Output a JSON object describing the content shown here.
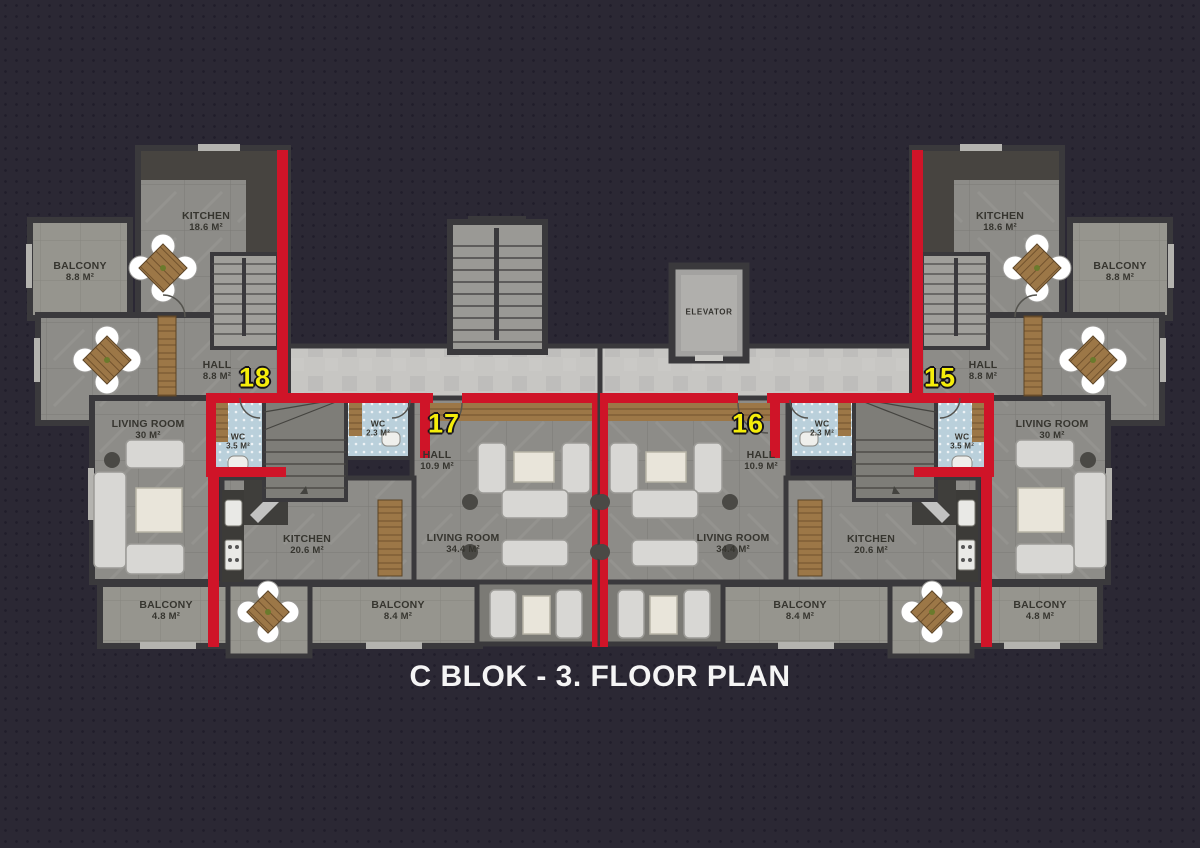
{
  "title": "C BLOK - 3. FLOOR PLAN",
  "units": {
    "u15": "15",
    "u16": "16",
    "u17": "17",
    "u18": "18"
  },
  "rooms": {
    "kitchen_186": {
      "name": "KITCHEN",
      "area": "18.6 M²"
    },
    "balcony_88": {
      "name": "BALCONY",
      "area": "8.8 M²"
    },
    "hall_88": {
      "name": "HALL",
      "area": "8.8 M²"
    },
    "living_30": {
      "name": "LIVING ROOM",
      "area": "30 M²"
    },
    "wc_35": {
      "name": "WC",
      "area": "3.5 M²"
    },
    "wc_23": {
      "name": "WC",
      "area": "2.3 M²"
    },
    "hall_109": {
      "name": "HALL",
      "area": "10.9 M²"
    },
    "kitchen_206": {
      "name": "KITCHEN",
      "area": "20.6 M²"
    },
    "living_344": {
      "name": "LIVING ROOM",
      "area": "34.4 M²"
    },
    "balcony_84": {
      "name": "BALCONY",
      "area": "8.4 M²"
    },
    "balcony_48": {
      "name": "BALCONY",
      "area": "4.8 M²"
    },
    "elevator": {
      "name": "ELEVATOR"
    }
  },
  "colors": {
    "background": "#2b2834",
    "wall": "#3a393c",
    "floor_gray": "#8d8c88",
    "corridor_gray": "#c7c6c3",
    "accent_red": "#cf1428",
    "unit_number_yellow": "#f5ed0a",
    "wc_tile_blue": "#bad0db",
    "wood": "#9c7747",
    "title_text": "#f5f5f5"
  }
}
